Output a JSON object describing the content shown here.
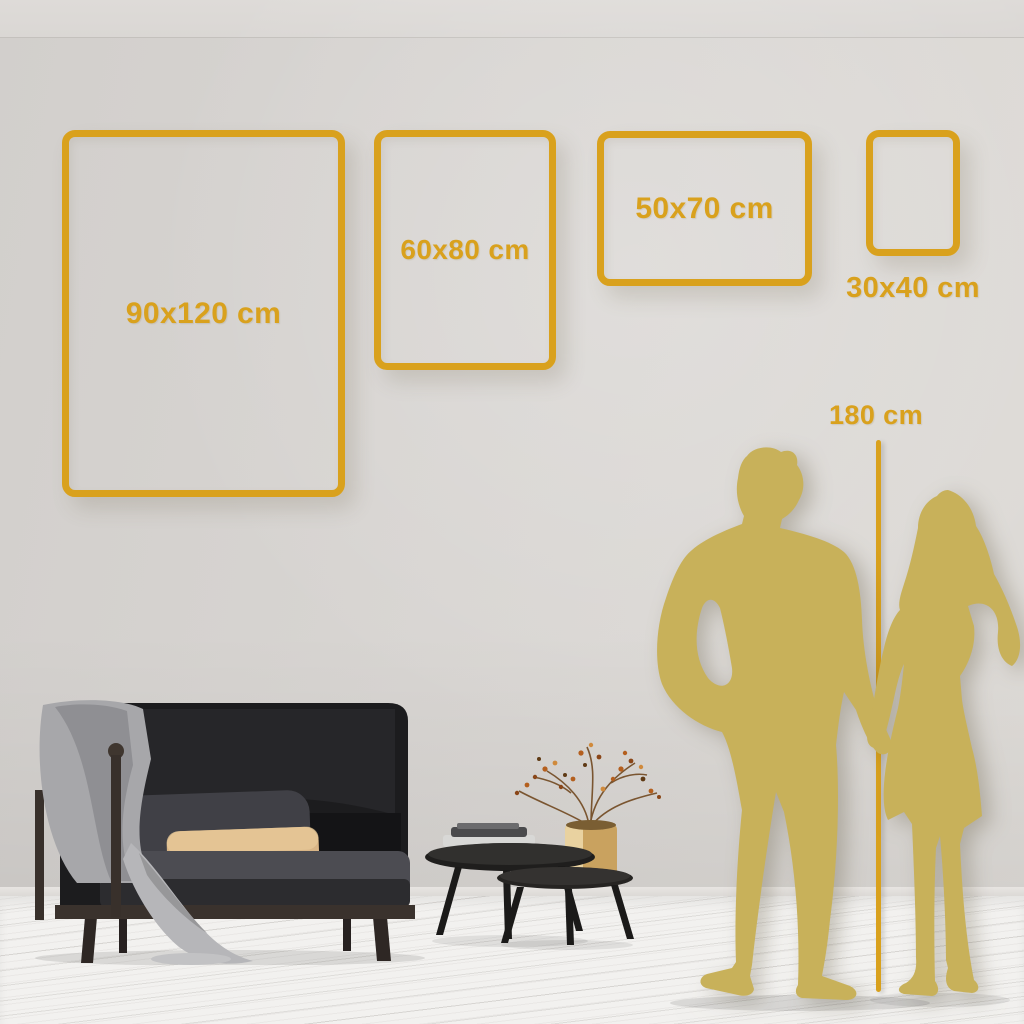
{
  "colors": {
    "accent_gold": "#D9A11D",
    "silhouette_gold": "#C8B15A",
    "wall_gray": "#D8D5D2",
    "floor_white": "#F2F1EF"
  },
  "frames": [
    {
      "name": "frame-90x120",
      "label": "90x120 cm",
      "width_cm": 90,
      "height_cm": 120,
      "orientation": "portrait",
      "label_placement": "inside"
    },
    {
      "name": "frame-60x80",
      "label": "60x80 cm",
      "width_cm": 60,
      "height_cm": 80,
      "orientation": "portrait",
      "label_placement": "inside"
    },
    {
      "name": "frame-50x70",
      "label": "50x70 cm",
      "width_cm": 50,
      "height_cm": 70,
      "orientation": "landscape",
      "label_placement": "inside"
    },
    {
      "name": "frame-30x40",
      "label": "30x40 cm",
      "width_cm": 30,
      "height_cm": 40,
      "orientation": "portrait",
      "label_placement": "below"
    }
  ],
  "height_marker": {
    "label": "180 cm",
    "value_cm": 180
  },
  "scene_icons": [
    "sofa-icon",
    "blanket-icon",
    "cushion-icon",
    "nesting-tables-icon",
    "books-icon",
    "vase-branch-icon",
    "man-silhouette-icon",
    "woman-silhouette-icon"
  ]
}
